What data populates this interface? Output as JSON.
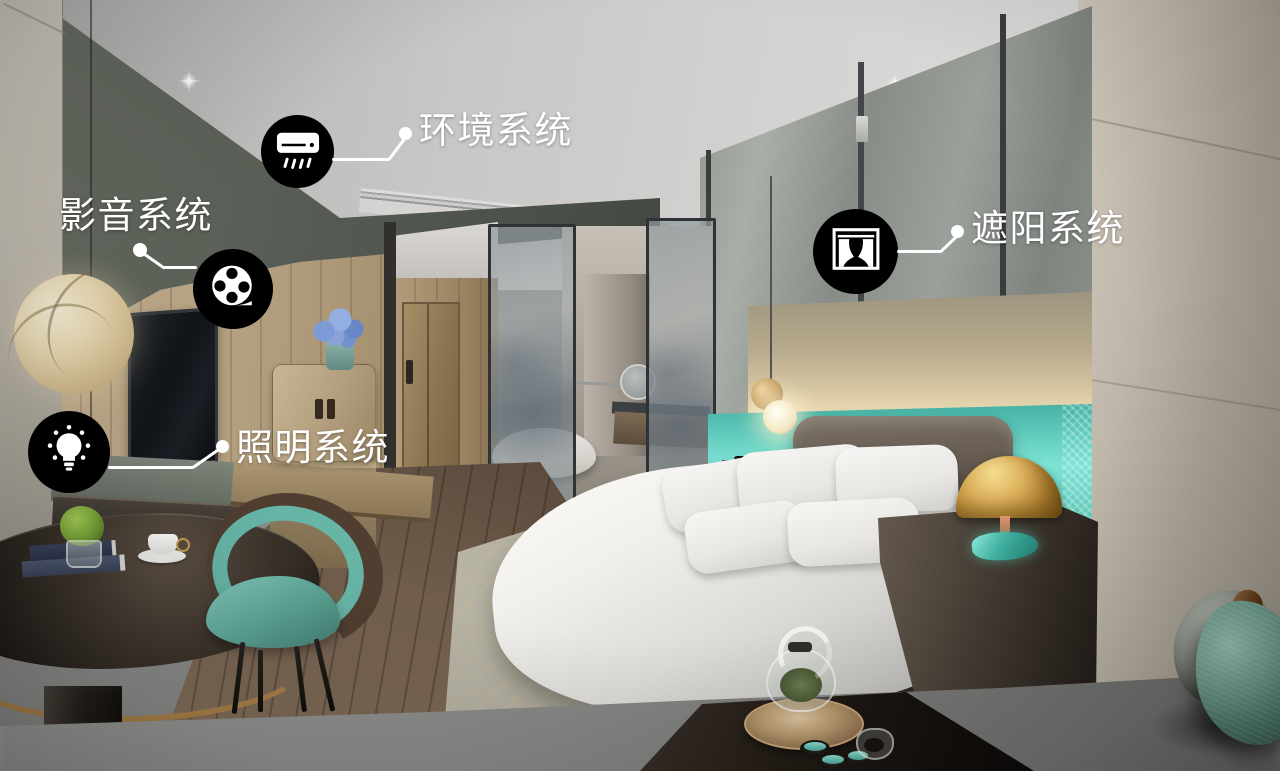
{
  "annotations": {
    "callouts": [
      {
        "id": "environment-system",
        "label": "环境系统",
        "icon": "air-conditioner-icon"
      },
      {
        "id": "audio-video-system",
        "label": "影音系统",
        "icon": "film-reel-icon"
      },
      {
        "id": "lighting-system",
        "label": "照明系统",
        "icon": "light-bulb-icon"
      },
      {
        "id": "shading-system",
        "label": "遮阳系统",
        "icon": "curtain-icon"
      }
    ],
    "style": {
      "badge_background": "#000000",
      "label_color": "#ffffff",
      "leader_color": "#ffffff"
    }
  },
  "scene": {
    "palette": {
      "ceiling": "#d0cecc",
      "wall_beige": "#bcb4a9",
      "wood": "#ab9674",
      "soffit_gray": "#53584f",
      "headboard_glass_teal": "#6fd8c9",
      "chair_teal": "#5fa896",
      "brass_lamp": "#c89e58",
      "bedding_white": "#efedeb",
      "floor_wood": "#6e5c4a",
      "foreground_gray": "#8a8a88"
    }
  }
}
